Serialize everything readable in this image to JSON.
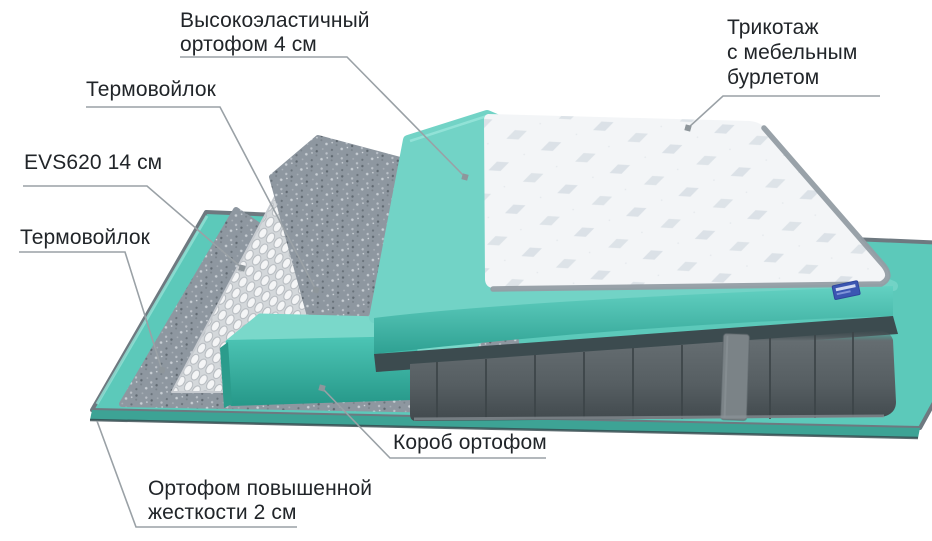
{
  "figure": {
    "kind": "mattress-layers-cutaway-diagram",
    "background": "#ffffff"
  },
  "palette": {
    "teal": "#5cc9ba",
    "teal-dark": "#2fa496",
    "felt-gray": "#8e97a0",
    "velvet-gray": "#565e62",
    "fabric-white": "#f3f5f7",
    "leader-gray": "#9aa1a6",
    "label-text": "#212529",
    "tag-blue": "#3b56b2"
  },
  "labels": {
    "foam4": "Высокоэластичный\nортофом 4 см",
    "felt_top": "Термовойлок",
    "springs": "EVS620 14 см",
    "felt_bottom": "Термовойлок",
    "knit": "Трикотаж\nс мебельным\nбурлетом",
    "box": "Короб ортофом",
    "base_foam": "Ортофом повышенной\nжесткости 2 см"
  }
}
